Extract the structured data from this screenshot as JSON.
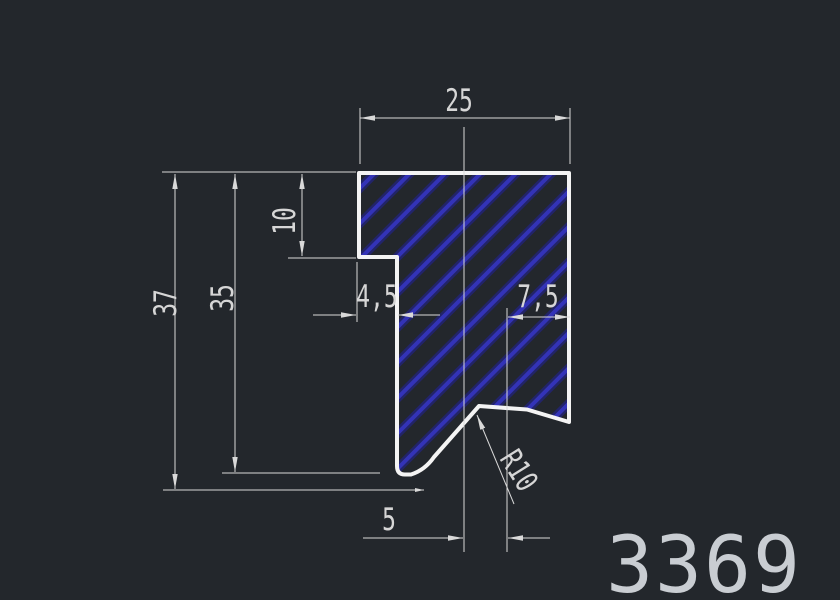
{
  "drawing": {
    "title_part_number": "3369",
    "canvas": {
      "background": "#23272c",
      "outline_color": "#f4f4f4",
      "hatch_color": "#3434c0",
      "annotation_color": "#d9d9d9"
    },
    "dimensions": {
      "top_width": "25",
      "lip_height": "10",
      "total_height": "37",
      "inner_height": "35",
      "step_width": "4,5",
      "right_offset": "7,5",
      "bottom_offset": "5",
      "fillet_radius": "R10"
    }
  }
}
